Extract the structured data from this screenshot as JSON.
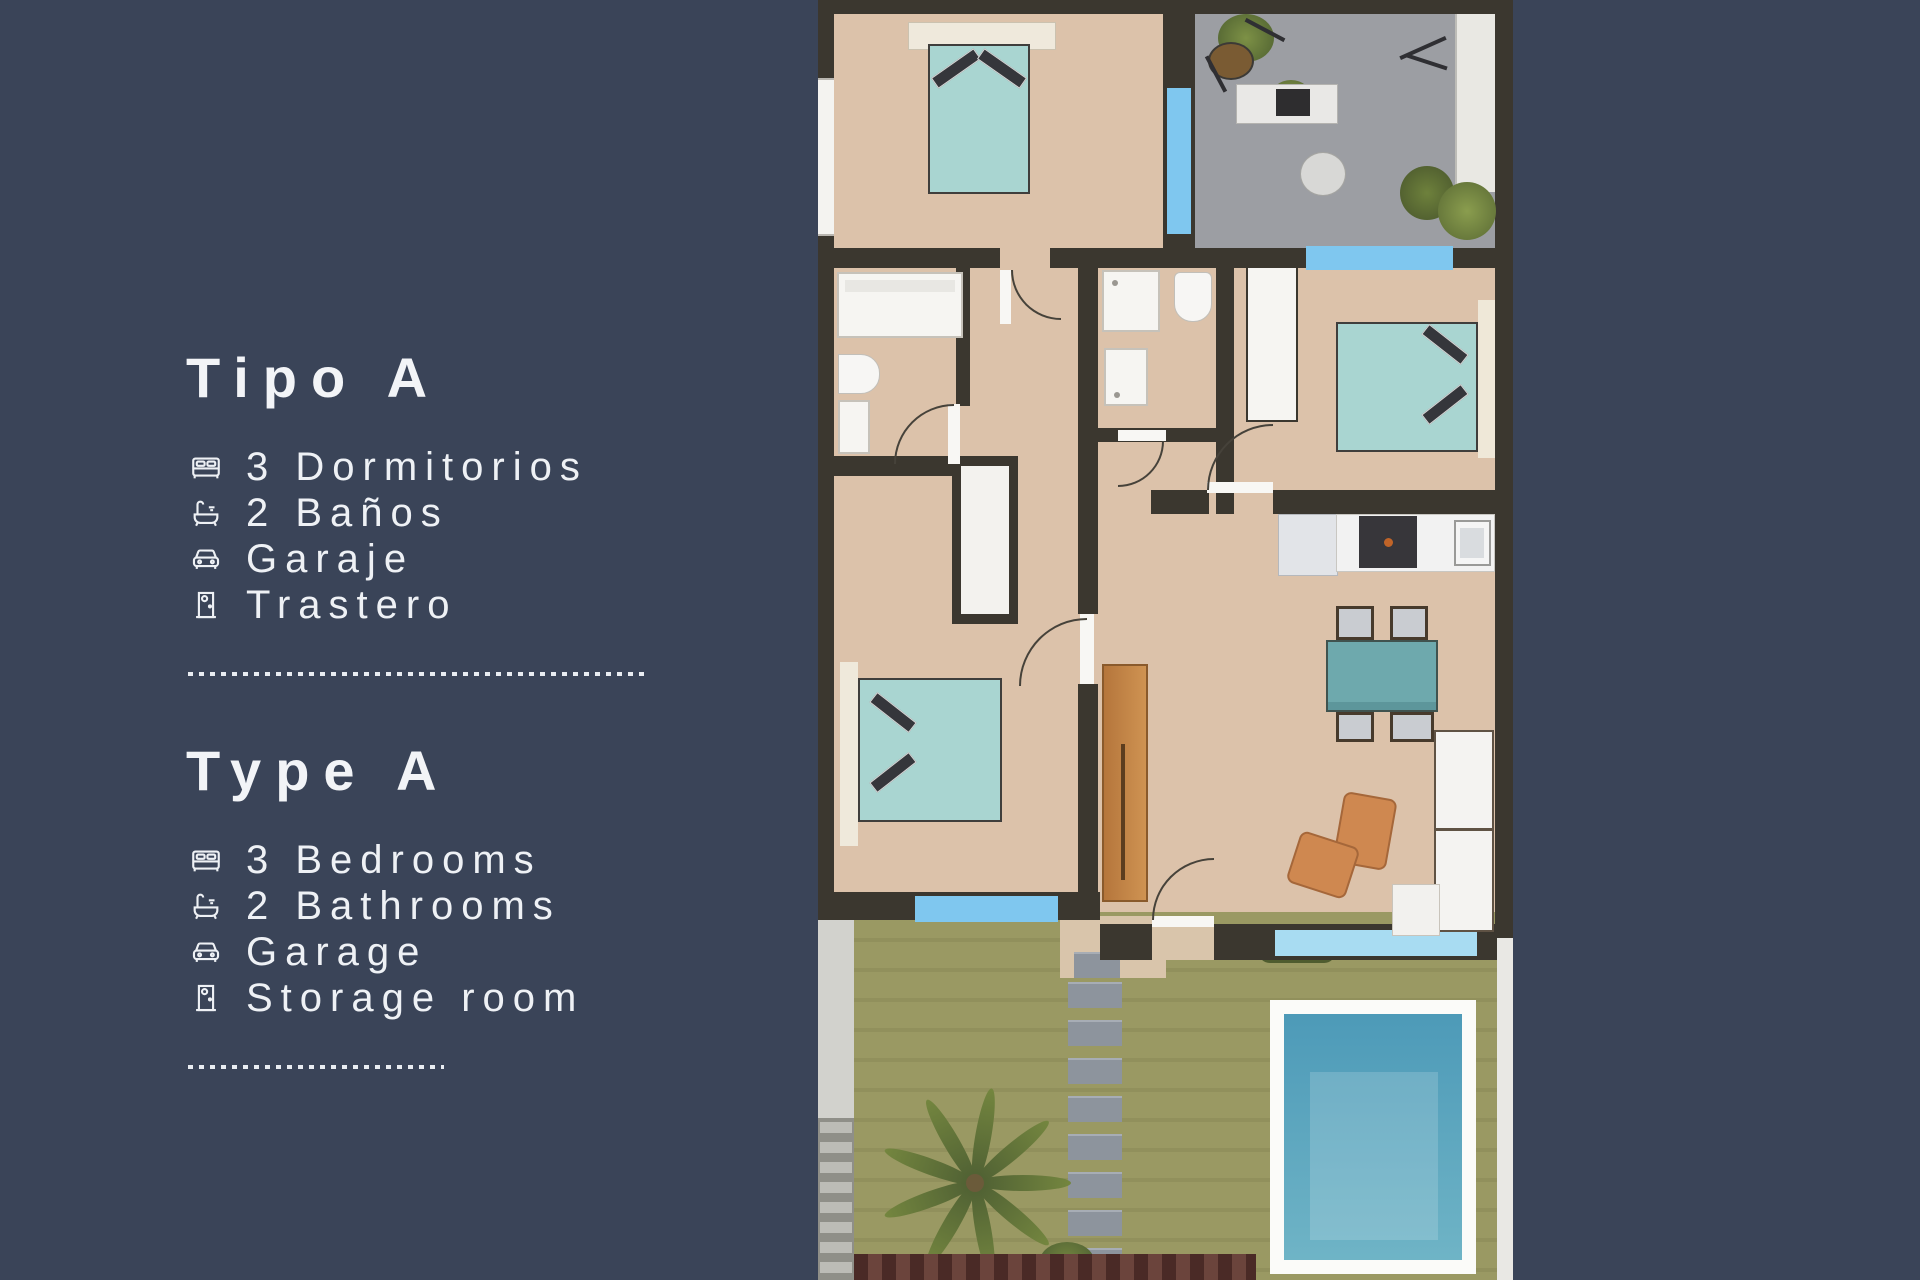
{
  "background_color": "#3a4458",
  "panel": {
    "sections": [
      {
        "title": "Tipo A",
        "items": [
          {
            "icon": "bed-icon",
            "label": "3 Dormitorios"
          },
          {
            "icon": "bathtub-icon",
            "label": "2 Baños"
          },
          {
            "icon": "car-icon",
            "label": "Garaje"
          },
          {
            "icon": "door-icon",
            "label": "Trastero"
          }
        ]
      },
      {
        "title": "Type A",
        "items": [
          {
            "icon": "bed-icon",
            "label": "3 Bedrooms"
          },
          {
            "icon": "bathtub-icon",
            "label": "2 Bathrooms"
          },
          {
            "icon": "car-icon",
            "label": "Garage"
          },
          {
            "icon": "door-icon",
            "label": "Storage room"
          }
        ]
      }
    ]
  },
  "floorplan": {
    "colors": {
      "wall": "#3b372f",
      "floor": "#dcc2aa",
      "terrace_floor": "#9c9ea3",
      "window_blue": "#7fc7ef",
      "bed_teal": "#a9d5d1",
      "dining_table_teal": "#6ea9ad",
      "garden_green": "#9a9963",
      "pool_water": "#4d9ab8",
      "pool_frame": "#fbfbf9",
      "wood_door": "#c08246",
      "armchair_orange": "#cf8850",
      "white_furniture": "#f6f5f2"
    }
  }
}
